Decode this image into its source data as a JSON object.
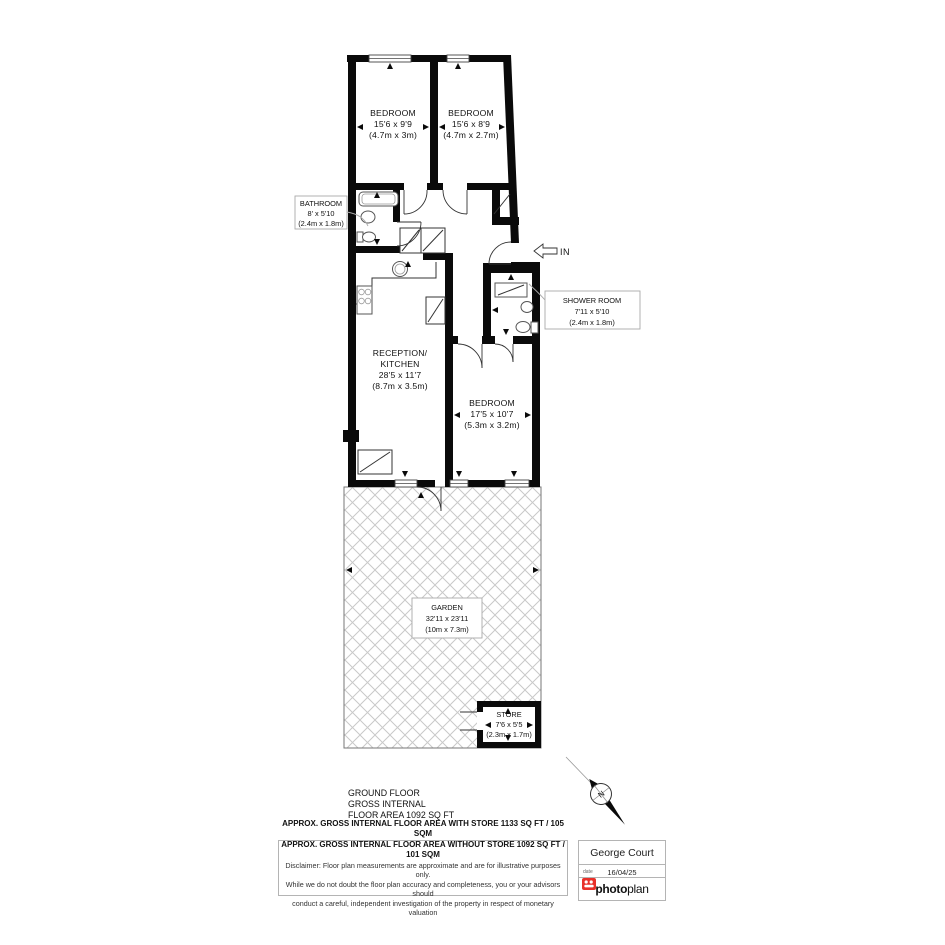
{
  "plan": {
    "rooms": {
      "bedroom1": {
        "name": "BEDROOM",
        "imperial": "15'6 x 9'9",
        "metric": "(4.7m x 3m)"
      },
      "bedroom2": {
        "name": "BEDROOM",
        "imperial": "15'6 x 8'9",
        "metric": "(4.7m x 2.7m)"
      },
      "bathroom": {
        "name": "BATHROOM",
        "imperial": "8' x 5'10",
        "metric": "(2.4m x 1.8m)"
      },
      "shower_room": {
        "name": "SHOWER ROOM",
        "imperial": "7'11 x 5'10",
        "metric": "(2.4m x 1.8m)"
      },
      "reception_kitchen": {
        "name1": "RECEPTION/",
        "name2": "KITCHEN",
        "imperial": "28'5 x 11'7",
        "metric": "(8.7m x 3.5m)"
      },
      "bedroom3": {
        "name": "BEDROOM",
        "imperial": "17'5 x 10'7",
        "metric": "(5.3m x 3.2m)"
      },
      "garden": {
        "name": "GARDEN",
        "imperial": "32'11 x 23'11",
        "metric": "(10m x 7.3m)"
      },
      "store": {
        "name": "STORE",
        "imperial": "7'6 x 5'5",
        "metric": "(2.3m x 1.7m)"
      }
    },
    "entrance_label": "IN",
    "compass_label": "N"
  },
  "title_block": {
    "line1": "GROUND FLOOR",
    "line2": "GROSS INTERNAL",
    "line3": "FLOOR AREA 1092 SQ FT"
  },
  "footer": {
    "area_with_store": "APPROX. GROSS INTERNAL FLOOR AREA WITH STORE 1133 SQ FT / 105 SQM",
    "area_without_store": "APPROX. GROSS INTERNAL FLOOR AREA WITHOUT STORE 1092 SQ FT / 101 SQM",
    "disclaimer1": "Disclaimer: Floor plan measurements are approximate and are for illustrative purposes only.",
    "disclaimer2": "While we do not doubt the floor plan accuracy and completeness, you or your advisors should",
    "disclaimer3": "conduct a careful, independent investigation of the property in respect of monetary valuation",
    "property_name": "George Court",
    "date_label": "date",
    "date_value": "16/04/25",
    "logo": {
      "part1": "photo",
      "part2": "plan"
    }
  },
  "colors": {
    "wall": "#000000",
    "logo_red": "#e8302a",
    "hatch": "#c9c9c9"
  }
}
